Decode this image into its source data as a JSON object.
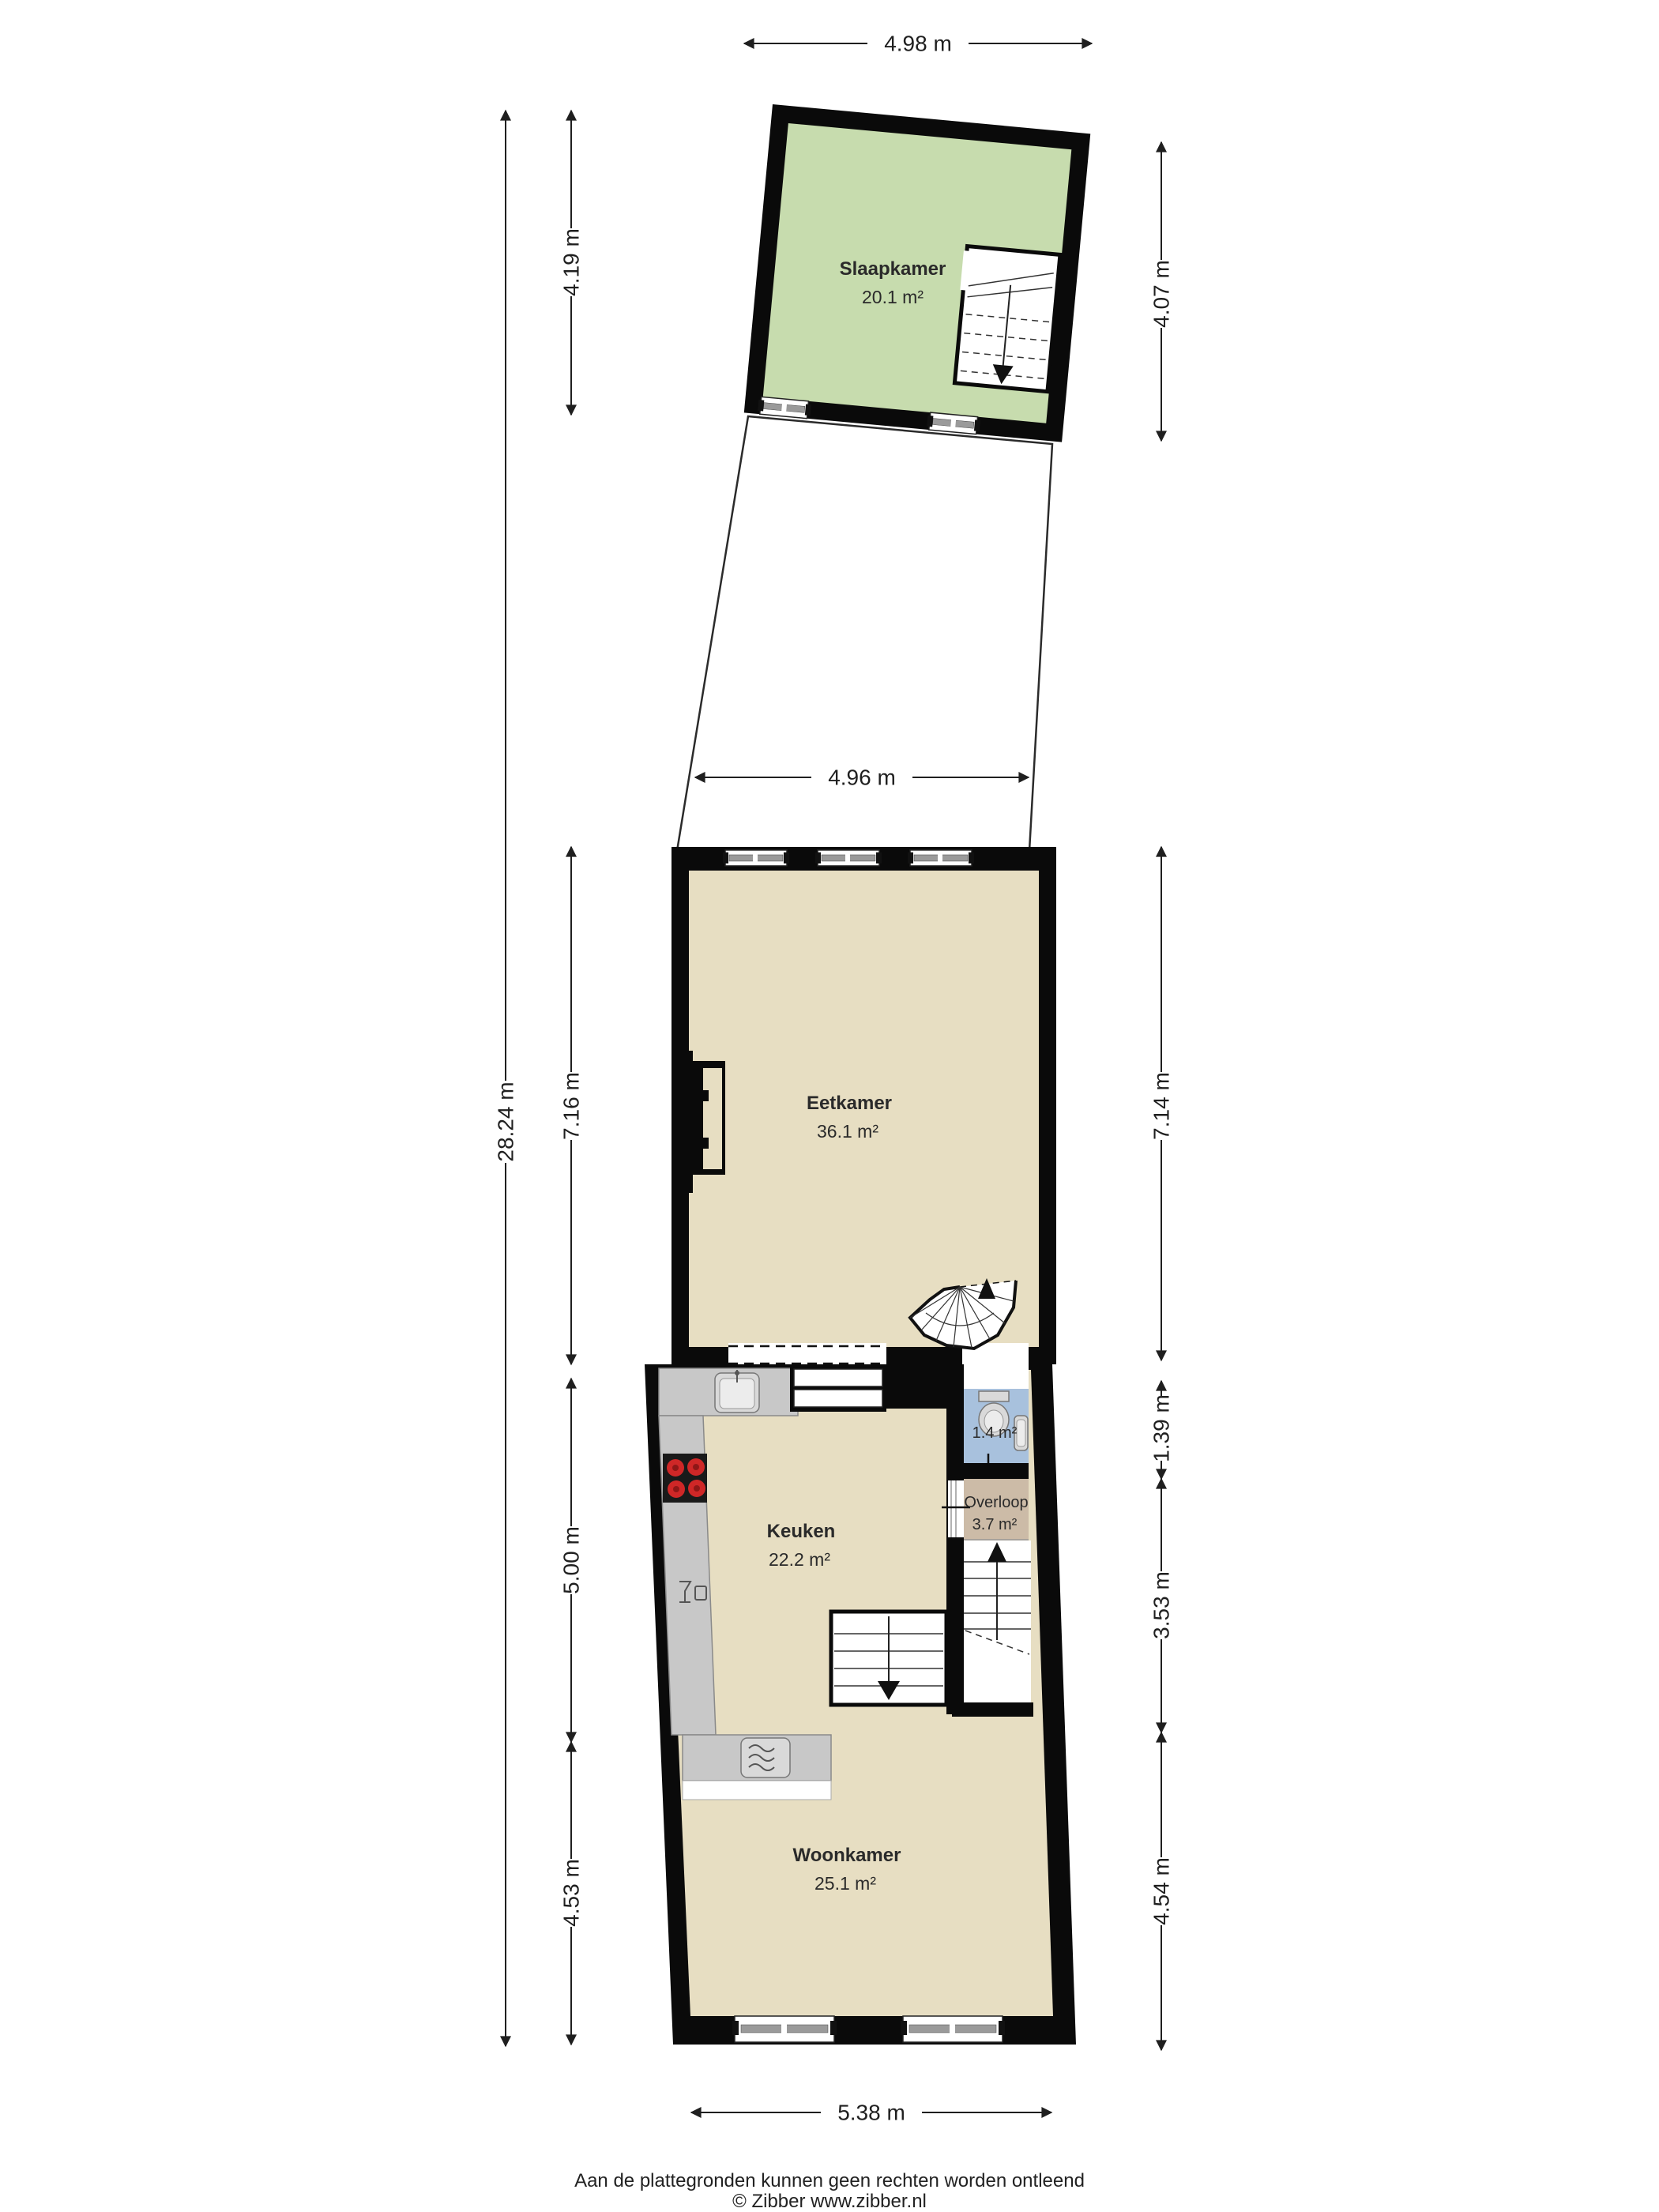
{
  "rooms": {
    "slaapkamer": {
      "name": "Slaapkamer",
      "area": "20.1 m²"
    },
    "eetkamer": {
      "name": "Eetkamer",
      "area": "36.1 m²"
    },
    "keuken": {
      "name": "Keuken",
      "area": "22.2 m²"
    },
    "toilet": {
      "area": "1.4 m²"
    },
    "overloop": {
      "name": "Overloop",
      "area": "3.7 m²"
    },
    "woonkamer": {
      "name": "Woonkamer",
      "area": "25.1 m²"
    }
  },
  "dimensions": {
    "top_width": "4.98 m",
    "bedroom_left": "4.19 m",
    "bedroom_right": "4.07 m",
    "mid_width": "4.96 m",
    "total_left": "28.24 m",
    "eetkamer_left": "7.16 m",
    "eetkamer_right": "7.14 m",
    "keuken_left": "5.00 m",
    "toilet_right": "1.39 m",
    "stairs_right": "3.53 m",
    "woonkamer_left": "4.53 m",
    "woonkamer_right": "4.54 m",
    "bottom_width": "5.38 m"
  },
  "footer": {
    "disclaimer": "Aan de plattegronden kunnen geen rechten worden ontleend",
    "copyright": "© Zibber www.zibber.nl"
  },
  "colors": {
    "wall": "#0a0a0a",
    "bedroom_floor": "#c7dcae",
    "main_floor": "#e7dec2",
    "overloop_floor": "#ccbba7",
    "toilet_floor": "#a8c1dd",
    "counter": "#c8c8c8",
    "counter_border": "#8a8a8a",
    "stove": "#1a1a1a",
    "burner": "#cf2727",
    "line": "#1f1f1f"
  }
}
